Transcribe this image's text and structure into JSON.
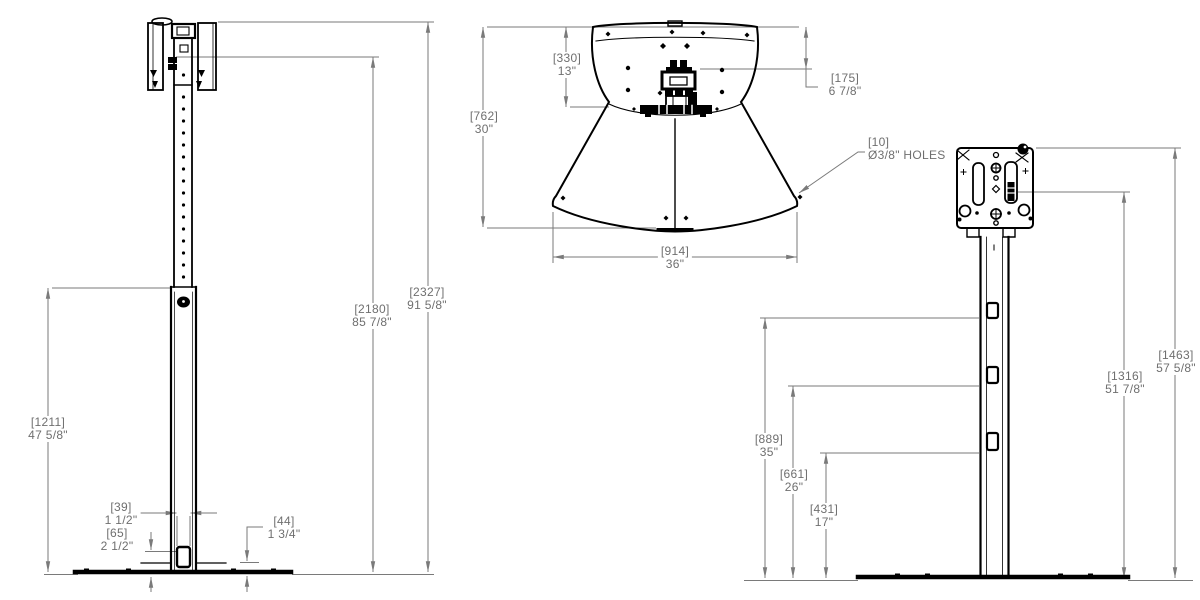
{
  "colors": {
    "edge": "#000000",
    "dimension": "#7a7a7a",
    "background": "#ffffff"
  },
  "dims": {
    "front_lower_height": {
      "metric": "[1211]",
      "imperial": "47 5/8\""
    },
    "front_mount_height": {
      "metric": "[2180]",
      "imperial": "85 7/8\""
    },
    "front_overall_height": {
      "metric": "[2327]",
      "imperial": "91 5/8\""
    },
    "front_cutout_width": {
      "metric": "[39]",
      "imperial": "1 1/2\""
    },
    "front_cutout_height": {
      "metric": "[65]",
      "imperial": "2 1/2\""
    },
    "front_base_height": {
      "metric": "[44]",
      "imperial": "1 3/4\""
    },
    "top_upper_depth": {
      "metric": "[330]",
      "imperial": "13\""
    },
    "top_overall_depth": {
      "metric": "[762]",
      "imperial": "30\""
    },
    "top_column_offset": {
      "metric": "[175]",
      "imperial": "6 7/8\""
    },
    "top_overall_width": {
      "metric": "[914]",
      "imperial": "36\""
    },
    "hole_callout": {
      "metric": "[10]",
      "imperial": "Ø3/8\" HOLES"
    },
    "side_hook_low": {
      "metric": "[431]",
      "imperial": "17\""
    },
    "side_hook_mid": {
      "metric": "[661]",
      "imperial": "26\""
    },
    "side_hook_high": {
      "metric": "[889]",
      "imperial": "35\""
    },
    "side_bracket_slot_height": {
      "metric": "[1316]",
      "imperial": "51 7/8\""
    },
    "side_overall_height": {
      "metric": "[1463]",
      "imperial": "57 5/8\""
    }
  }
}
